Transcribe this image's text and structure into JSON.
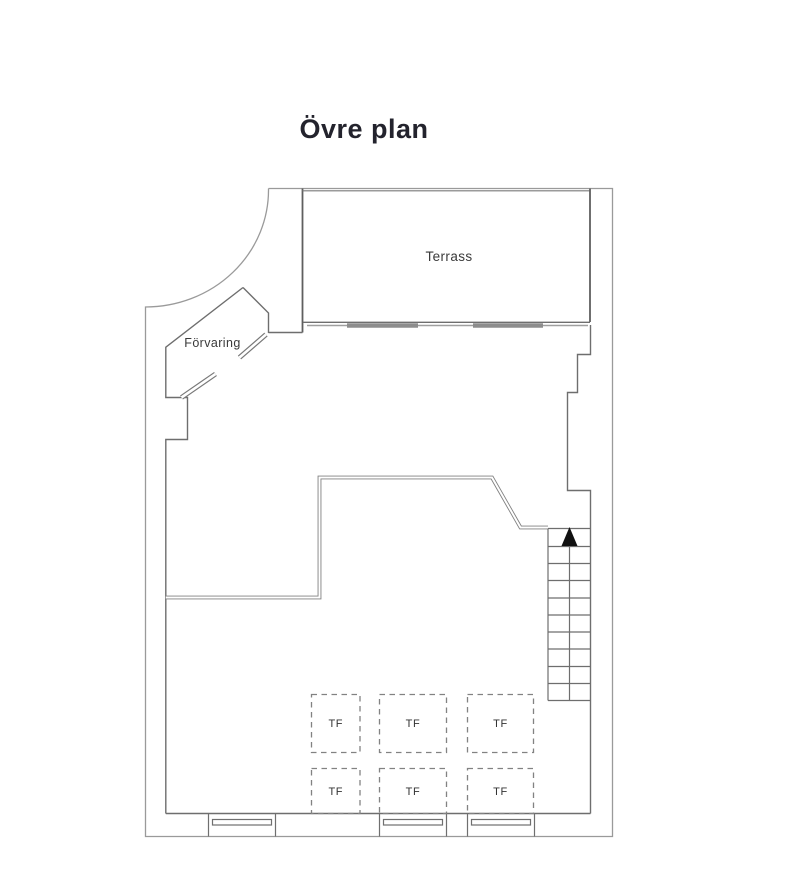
{
  "page": {
    "title": "Övre plan",
    "background": "#ffffff"
  },
  "plan": {
    "rooms": [
      {
        "id": "terrace",
        "label": "Terrass"
      },
      {
        "id": "storage",
        "label": "Förvaring"
      }
    ],
    "skylights": [
      {
        "label": "TF"
      },
      {
        "label": "TF"
      },
      {
        "label": "TF"
      },
      {
        "label": "TF"
      },
      {
        "label": "TF"
      },
      {
        "label": "TF"
      }
    ],
    "stairs": {
      "symbol": "up-arrow",
      "treads": 10
    },
    "windows": {
      "count": 3
    },
    "colors": {
      "background": "#ffffff",
      "outer_wall": "#9a9a9a",
      "inner_wall": "#6e6e6e",
      "railing": "#808080",
      "glass_door": "#8d8d8d",
      "stair_arrow": "#111111",
      "label_text": "#3a3a3a",
      "title_text": "#23232d"
    }
  }
}
